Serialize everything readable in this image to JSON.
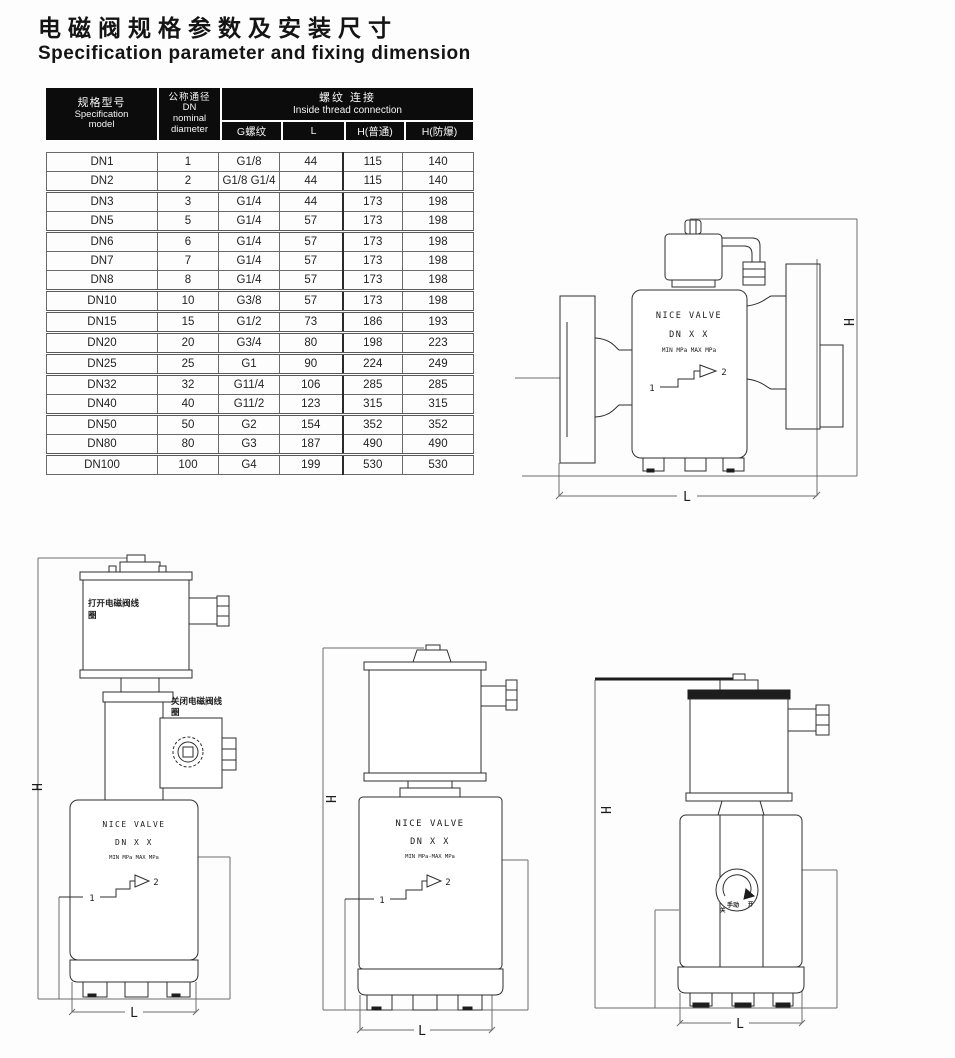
{
  "page": {
    "title_cn": "电磁阀规格参数及安装尺寸",
    "title_en": "Specification parameter and fixing dimension"
  },
  "table": {
    "headers": {
      "col1": {
        "cn": "规格型号",
        "en": "Specification",
        "en2": "model"
      },
      "col2": {
        "cn": "公称通径",
        "l2": "DN",
        "l3": "nominal",
        "l4": "diameter"
      },
      "group": {
        "cn": "螺纹 连接",
        "en": "Inside thread connection"
      },
      "sub": {
        "g": "G螺纹",
        "l": "L",
        "h_std": "H(普通)",
        "h_ex": "H(防爆)"
      }
    },
    "rows": [
      {
        "model": "DN1",
        "dn": "1",
        "g": "G1/8",
        "l": "44",
        "h_std": "115",
        "h_ex": "140"
      },
      {
        "model": "DN2",
        "dn": "2",
        "g": "G1/8 G1/4",
        "l": "44",
        "h_std": "115",
        "h_ex": "140"
      },
      {
        "model": "DN3",
        "dn": "3",
        "g": "G1/4",
        "l": "44",
        "h_std": "173",
        "h_ex": "198",
        "group_start": true
      },
      {
        "model": "DN5",
        "dn": "5",
        "g": "G1/4",
        "l": "57",
        "h_std": "173",
        "h_ex": "198"
      },
      {
        "model": "DN6",
        "dn": "6",
        "g": "G1/4",
        "l": "57",
        "h_std": "173",
        "h_ex": "198",
        "group_start": true
      },
      {
        "model": "DN7",
        "dn": "7",
        "g": "G1/4",
        "l": "57",
        "h_std": "173",
        "h_ex": "198"
      },
      {
        "model": "DN8",
        "dn": "8",
        "g": "G1/4",
        "l": "57",
        "h_std": "173",
        "h_ex": "198"
      },
      {
        "model": "DN10",
        "dn": "10",
        "g": "G3/8",
        "l": "57",
        "h_std": "173",
        "h_ex": "198",
        "group_start": true
      },
      {
        "model": "DN15",
        "dn": "15",
        "g": "G1/2",
        "l": "73",
        "h_std": "186",
        "h_ex": "193",
        "group_start": true
      },
      {
        "model": "DN20",
        "dn": "20",
        "g": "G3/4",
        "l": "80",
        "h_std": "198",
        "h_ex": "223",
        "group_start": true
      },
      {
        "model": "DN25",
        "dn": "25",
        "g": "G1",
        "l": "90",
        "h_std": "224",
        "h_ex": "249",
        "group_start": true
      },
      {
        "model": "DN32",
        "dn": "32",
        "g": "G11/4",
        "l": "106",
        "h_std": "285",
        "h_ex": "285",
        "group_start": true
      },
      {
        "model": "DN40",
        "dn": "40",
        "g": "G11/2",
        "l": "123",
        "h_std": "315",
        "h_ex": "315"
      },
      {
        "model": "DN50",
        "dn": "50",
        "g": "G2",
        "l": "154",
        "h_std": "352",
        "h_ex": "352",
        "group_start": true
      },
      {
        "model": "DN80",
        "dn": "80",
        "g": "G3",
        "l": "187",
        "h_std": "490",
        "h_ex": "490"
      },
      {
        "model": "DN100",
        "dn": "100",
        "g": "G4",
        "l": "199",
        "h_std": "530",
        "h_ex": "530",
        "group_start": true
      }
    ]
  },
  "drawings": {
    "valve_text": {
      "line1": "NICE VALVE",
      "line2": "DN X X",
      "line3": "MIN  MPa MAX  MPa",
      "line3_dash": "MIN  MPa-MAX  MPa"
    },
    "dims": {
      "h": "H",
      "l": "L"
    },
    "ports": {
      "in": "1",
      "out": "2"
    },
    "labels": {
      "open_coil_l1": "打开电磁阀线",
      "open_coil_l2": "圈",
      "close_coil_l1": "关闭电磁阀线",
      "close_coil_l2": "圈",
      "manual": "手动",
      "manual_open": "开",
      "manual_close": "关"
    }
  }
}
